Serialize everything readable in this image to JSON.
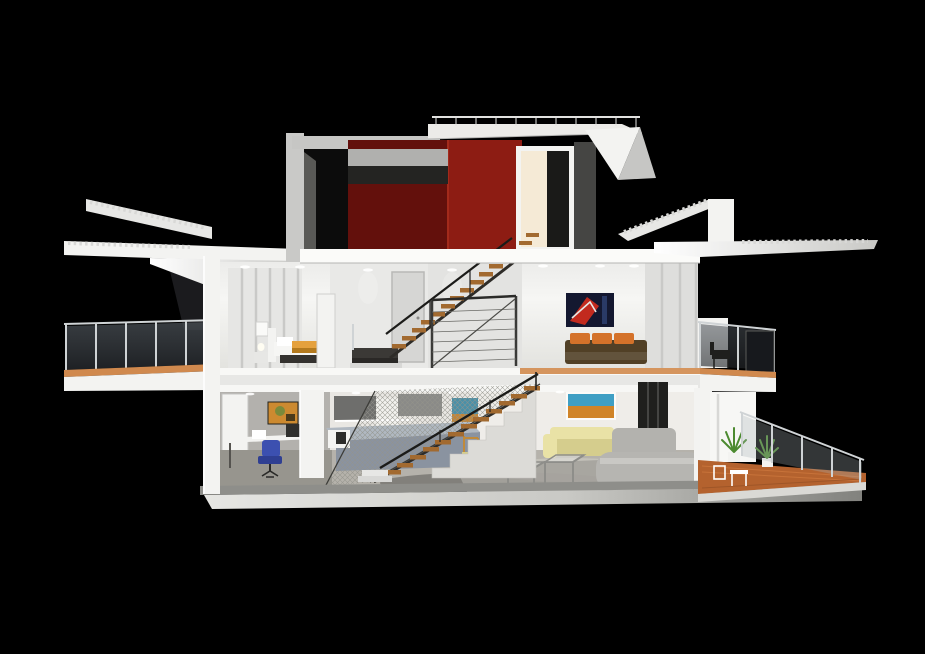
{
  "meta": {
    "description": "3D rendered cutaway cross-section of a modern two-storey house with roof terrace, shown against a black background",
    "view": "sectional elevation, slight top-down perspective"
  },
  "palette": {
    "background": "#000000",
    "red_dark": "#63100c",
    "red_bright": "#8d1c13",
    "red_edge": "#a32a1b",
    "warm_light": "#f5ead6",
    "tread_wood": "#a26a30",
    "handrail": "#1b1b19",
    "bed_blanket": "#e5a13d",
    "bed_stripe": "#b47a1e",
    "cushion_orange": "#d4722a",
    "sofa_brown": "#514026",
    "sofa_yellow": "#e9e2a6",
    "sofa_yellow_dark": "#d5cd8d",
    "chair_blue": "#3c50b0",
    "chair_blue_dark": "#2f3f92",
    "counter_face": "#8a93a0",
    "counter_top": "#b0b8c1",
    "wood_floor": "#d0894e",
    "deck_wood": "#b4622e",
    "deck_stripe": "#d07a3f",
    "plant_green": "#4c8a30",
    "art_navy": "#141830",
    "art_red": "#c22a1e",
    "art_sky": "#3f9fc4",
    "art_field": "#d08428",
    "art_teal": "#4a90a8",
    "office_art": "#cc8a30",
    "office_art_green": "#7a8a3a",
    "glass_tint": "#30343a",
    "panel_gray": "#454543",
    "door_gray": "#d6d6d4"
  },
  "scene": {
    "levels": [
      {
        "name": "roof",
        "features": [
          "roof terrace with slim metal railing",
          "red stairwell tower",
          "cantilevered roof overhangs with exposed joists"
        ]
      },
      {
        "name": "upper-floor",
        "rooms": [
          {
            "name": "bedroom",
            "objects": [
              "bed with white pillows and orange blanket",
              "nightstand with lamp",
              "wardrobe closet panels",
              "white door"
            ]
          },
          {
            "name": "stair-hall",
            "objects": [
              "gray door",
              "timber-tread staircase",
              "cable railing with diagonal brace",
              "landing"
            ]
          },
          {
            "name": "living-room",
            "objects": [
              "red and navy abstract painting",
              "brown sofa with orange cushions",
              "sliding glass doors"
            ]
          },
          {
            "name": "left-balcony",
            "objects": [
              "glass balustrade",
              "timber decking strip"
            ]
          },
          {
            "name": "right-balcony",
            "objects": [
              "glass balustrade",
              "dark lounge chair",
              "tinted glass panel"
            ]
          }
        ]
      },
      {
        "name": "ground-floor",
        "rooms": [
          {
            "name": "office-nook",
            "objects": [
              "desk with monitor",
              "blue swivel chair",
              "orange abstract print"
            ]
          },
          {
            "name": "kitchen",
            "objects": [
              "gray wall cabinets",
              "blue-gray island counter",
              "coffee maker"
            ]
          },
          {
            "name": "stair",
            "objects": [
              "timber-tread staircase",
              "triangular safety net",
              "white stepped plinth"
            ]
          },
          {
            "name": "living-dining",
            "objects": [
              "landscape painting with blue sky and orange field",
              "small teal painting",
              "pale yellow sofa",
              "two wooden dining chairs",
              "two glass cube side tables",
              "gray lounge daybed",
              "dark slatted fireplace column"
            ]
          },
          {
            "name": "terrace-deck",
            "objects": [
              "terracotta timber decking",
              "two potted green plants",
              "white outdoor furniture",
              "sloping glass balustrade"
            ]
          }
        ]
      }
    ]
  }
}
